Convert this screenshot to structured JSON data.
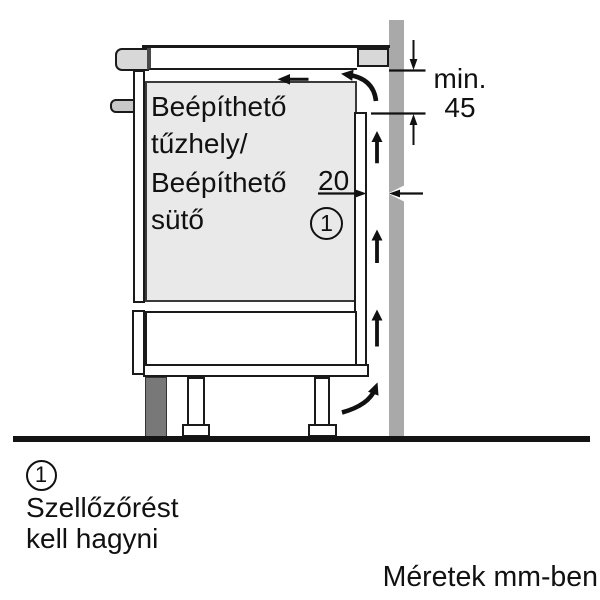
{
  "diagram": {
    "oven_label": {
      "line1": "Beépíthető",
      "line2": "tűzhely/",
      "line3": "Beépíthető",
      "line4": "sütő"
    },
    "dimensions": {
      "top_clearance_prefix": "min.",
      "top_clearance_value": "45",
      "rear_gap_value": "20",
      "units_implied": "mm"
    },
    "callout": {
      "number": "1"
    }
  },
  "legend": {
    "number": "1",
    "text_line1": "Szellőzőrést",
    "text_line2": "kell hagyni"
  },
  "footer": {
    "units_note": "Méretek mm-ben"
  },
  "colors": {
    "background": "#ffffff",
    "wall_gray": "#a9a9a9",
    "plinth_gray": "#787878",
    "oven_fill": "#e9e9e9",
    "trim_gray": "#d8d8d8",
    "line_black": "#1a1a1a"
  },
  "icons": {
    "airflow_up_arrow": "↑",
    "airflow_turn_left_arrow": "↖",
    "airflow_turn_up_arrow": "↗",
    "dimension_down_arrow": "↓",
    "dimension_up_arrow": "↑",
    "dimension_left_arrow": "←",
    "dimension_right_arrow": "→"
  }
}
